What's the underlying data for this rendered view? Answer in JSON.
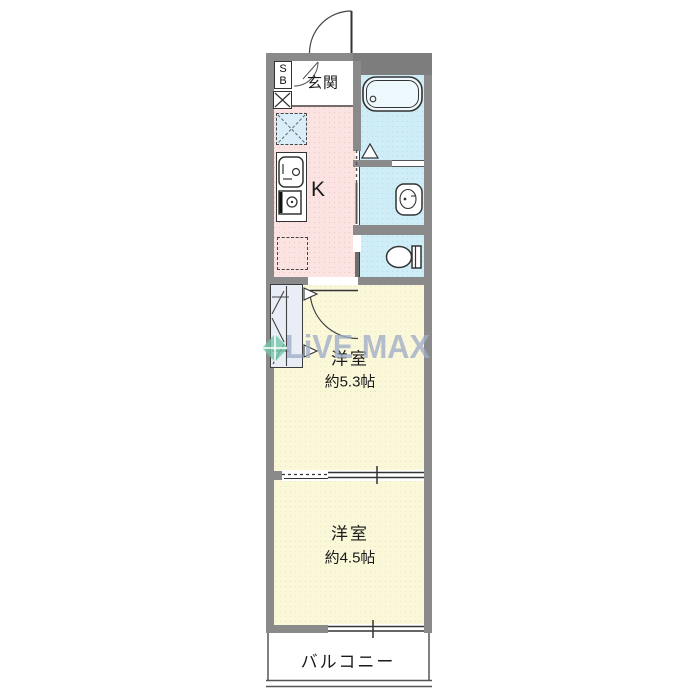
{
  "floorplan": {
    "labels": {
      "entrance": "玄関",
      "kitchen": "K",
      "balcony": "バルコニー"
    },
    "shoe_box": {
      "line1": "S",
      "line2": "B"
    },
    "rooms": [
      {
        "name": "洋室",
        "size": "約5.3帖"
      },
      {
        "name": "洋室",
        "size": "約4.5帖"
      }
    ],
    "watermark": {
      "text": "LiVE MAX"
    },
    "colors": {
      "wall": "#8a8a8a",
      "wall_dark": "#7d7d7d",
      "kitchen": "#fae3e1",
      "room": "#fbf8da",
      "wet": "#cfedf7",
      "closet": "#e9eef6",
      "wm_text": "#9fadc7",
      "wm_logo": "#74c6aa",
      "line": "#333333"
    }
  }
}
